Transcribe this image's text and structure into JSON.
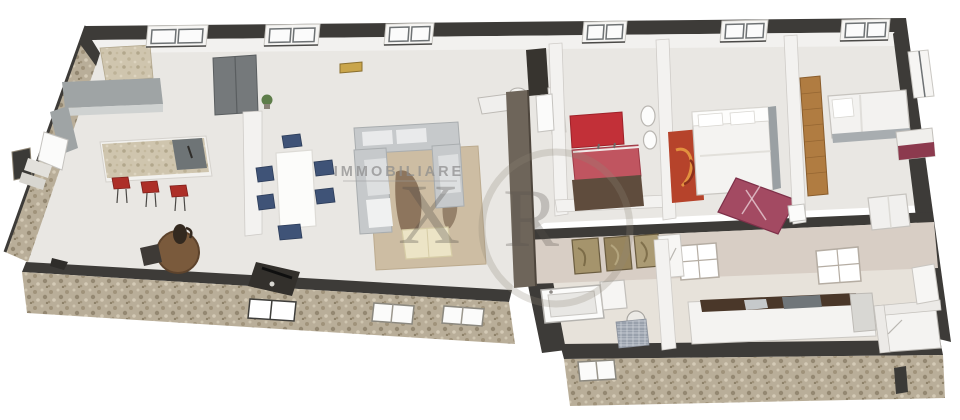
{
  "watermark": {
    "brand": "IMMOBILIARE",
    "monogram_left": "X",
    "monogram_right": "R"
  },
  "palette": {
    "wall_dark": "#3d3b38",
    "stone_base": "#b9ae99",
    "floor_upper": "#e9e7e3",
    "floor_lower": "#e7e2da",
    "corridor_wall_pink": "#d8cec5",
    "accent_red_wall": "#c23038",
    "vanity_red": "#c05560",
    "stool_red": "#ad2f28",
    "chair_navy": "#3f5377",
    "sofa_gray": "#c6c9cb",
    "rug_beige": "#cdbda3",
    "rug_red": "#b6432b",
    "chaise_maroon": "#a34a62",
    "wood": "#b07c41",
    "counter_gray": "#9fa4a5",
    "countertop_brown": "#4a3729",
    "watermark_gray": "#8c8c8c"
  }
}
